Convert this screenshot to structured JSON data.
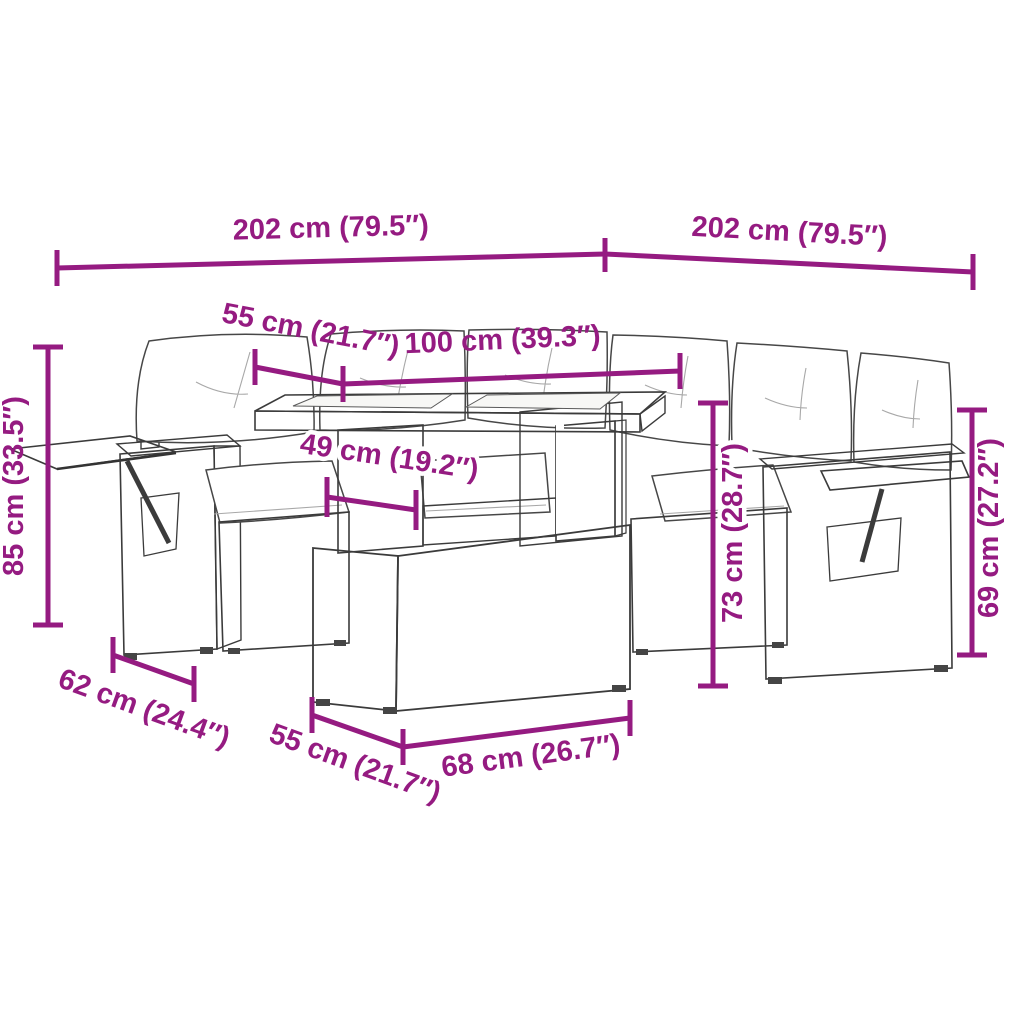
{
  "meta": {
    "accent_color": "#951B81",
    "illustration": "rattan-garden-corner-sofa-set-with-adjustable-table-line-drawing"
  },
  "dims": {
    "top_left_202": "202 cm (79.5″)",
    "top_right_202": "202 cm (79.5″)",
    "back_55": "55 cm (21.7″)",
    "back_100": "100 cm (39.3″)",
    "table_49": "49 cm (19.2″)",
    "left_85": "85 cm (33.5″)",
    "mid_73": "73 cm (28.7″)",
    "right_69": "69 cm (27.2″)",
    "depth_62": "62 cm (24.4″)",
    "front_55": "55 cm (21.7″)",
    "front_68": "68 cm (26.7″)"
  }
}
